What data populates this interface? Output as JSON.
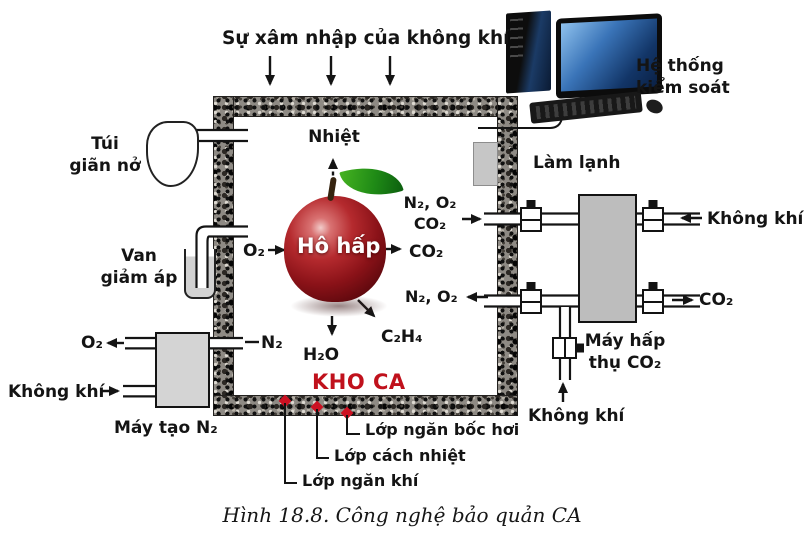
{
  "diagram": {
    "top": {
      "air_ingress": "Sự xâm nhập của không khí",
      "control_system": [
        "Hệ thống",
        "kiểm soát"
      ]
    },
    "chamber": {
      "name": "KHO CA",
      "heat": "Nhiệt",
      "respiration": "Hô hấp",
      "o2": "O₂",
      "outflow": [
        "N₂, O₂",
        "CO₂"
      ],
      "co2": "CO₂",
      "inflow": "N₂, O₂",
      "ethylene": "C₂H₄",
      "water": "H₂O",
      "n2": "N₂"
    },
    "left": {
      "expansion_bag": [
        "Túi",
        "giãn nở"
      ],
      "relief_valve": [
        "Van",
        "giảm áp"
      ],
      "o2_out": "O₂",
      "air_in": "Không khí",
      "n2_generator": "Máy tạo N₂"
    },
    "right": {
      "cooling": "Làm lạnh",
      "air_in": "Không khí",
      "co2_out": "CO₂",
      "co2_absorber": [
        "Máy hấp",
        "thụ CO₂"
      ],
      "air_in_bottom": "Không khí"
    },
    "layers": {
      "evaporation_barrier": "Lớp ngăn bốc hơi",
      "thermal_insulation": "Lớp cách nhiệt",
      "gas_barrier": "Lớp ngăn khí"
    },
    "caption": "Hình 18.8. Công nghệ bảo quản CA",
    "colors": {
      "storage_label": "#c0111c",
      "marker_dot": "#cc1122",
      "apple_red": "#8a1218",
      "leaf_green": "#1f8a16",
      "wall_base": "#8e8a84",
      "unit_gray": "#c9c9c9",
      "screen_blue": "#3a74b8"
    }
  }
}
